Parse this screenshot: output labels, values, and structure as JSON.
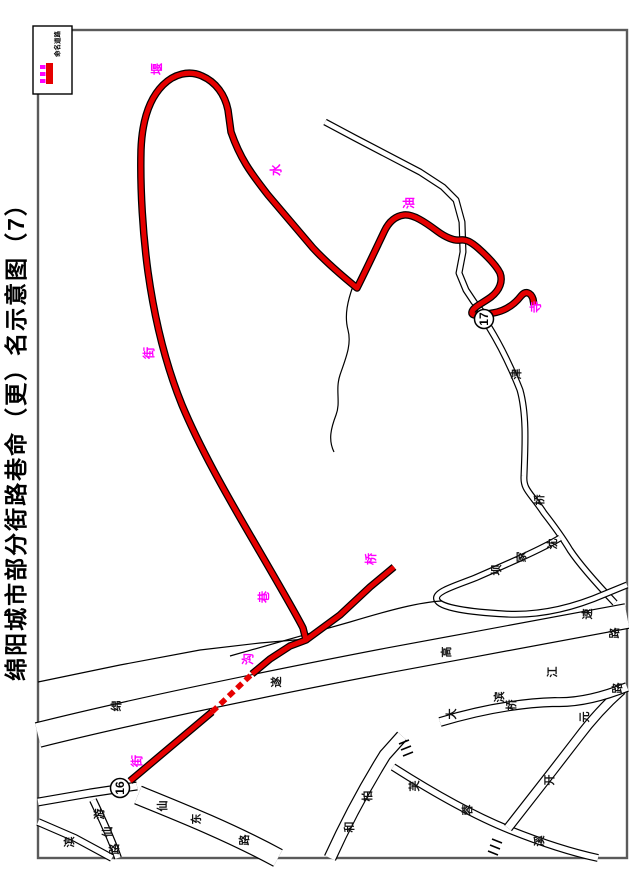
{
  "title": "绵阳城市部分街路巷命（更）名示意图（7）",
  "colors": {
    "red": "#e60000",
    "magenta": "#ff00ff",
    "ink": "#000000",
    "frame": "#5a5a5a"
  },
  "legend": {
    "label": "命名道路",
    "box": {
      "x": 33,
      "y": 26,
      "w": 39,
      "h": 68
    },
    "bar": {
      "x": 46,
      "y": 63,
      "w": 7,
      "h": 21
    },
    "ticks": [
      {
        "x": 40,
        "y": 65
      },
      {
        "x": 40,
        "y": 72
      },
      {
        "x": 40,
        "y": 79
      }
    ]
  },
  "markers": [
    {
      "label": "16",
      "x": 120,
      "y": 788
    },
    {
      "label": "17",
      "x": 484,
      "y": 319
    }
  ],
  "map": {
    "frame": {
      "x": 38,
      "y": 30,
      "w": 589,
      "h": 828
    },
    "roads": [
      {
        "d": "M38,735 C130,712 260,685 390,660 C470,645 565,628 627,616",
        "w": 26
      },
      {
        "d": "M325,122 L355,138 L420,172 L443,187 L456,200 L462,222 L463,252 L459,273 L466,290 L474,302 L482,312",
        "w": 7
      },
      {
        "d": "M489,327 C497,340 509,362 520,390 C527,415 525,448 524,476 C523,490 531,493 544,513 C551,522 561,535 570,550 C580,565 598,585 615,603",
        "w": 7
      },
      {
        "d": "M560,538 C540,550 505,565 475,578 C455,586 433,592 437,600 C440,608 470,612 505,614 C540,616 575,607 605,594 L627,585",
        "w": 7
      },
      {
        "d": "M353,286 C348,300 344,315 348,330 C352,345 345,360 340,375 C335,390 341,402 336,415 C331,428 328,440 334,452",
        "w": 0
      },
      {
        "d": "M38,682 L120,665 L200,650 L260,643 L306,639",
        "w": 0
      },
      {
        "d": "M230,656 L350,622 C390,610 420,602 442,601",
        "w": 0
      },
      {
        "d": "M38,802 L90,793 L137,786",
        "w": 9
      },
      {
        "d": "M93,800 C100,815 110,835 118,858",
        "w": 8
      },
      {
        "d": "M138,795 C180,812 230,832 278,858",
        "w": 20
      },
      {
        "d": "M38,822 L75,838 L112,858",
        "w": 8
      },
      {
        "d": "M330,858 C345,825 362,792 385,755 L402,736",
        "w": 13
      },
      {
        "d": "M393,767 C440,797 480,818 510,830 C540,842 570,852 598,858",
        "w": 8
      },
      {
        "d": "M508,828 C530,800 555,768 578,738 C590,722 605,705 622,690",
        "w": 10
      },
      {
        "d": "M440,722 C480,710 520,703 555,702 C580,703 607,695 627,687",
        "w": 10
      }
    ],
    "hatches": [
      "M399,744 L409,740 M401,750 L411,746 M403,756 L413,752",
      "M492,839 L502,843 M490,845 L500,849 M488,851 L498,855"
    ],
    "red_route": [
      {
        "d": "M130,781 L212,712",
        "dash": false
      },
      {
        "d": "M212,712 L252,674",
        "dash": true
      },
      {
        "d": "M252,674 L270,659 L290,646 L306,640 L303,628 C295,612 275,578 250,535 C225,492 200,448 182,405 C167,368 155,322 148,272 C143,235 140,190 141,150 C142,122 149,99 163,85 C174,74 189,70 202,76 C216,82 225,95 228,110 L231,132 C240,158 250,172 268,195 C285,215 296,228 313,248 C326,262 341,275 357,288 C365,272 375,251 384,232 C389,221 396,216 404,215 C413,214 425,222 437,231 C445,237 454,241 460,240 C466,239 471,242 478,248 C487,256 496,265 500,273 C503,281 500,290 491,297 C483,303 473,307 472,312 C471,317 481,315 493,313 C505,311 514,305 521,296 C526,290 531,293 533,299 L534,305",
        "dash": false
      },
      {
        "d": "M306,640 L340,615 L370,587 L394,567",
        "dash": false
      }
    ],
    "labels": [
      {
        "t": "绵",
        "x": 117,
        "y": 706,
        "c": "k"
      },
      {
        "t": "遂",
        "x": 277,
        "y": 682,
        "c": "k"
      },
      {
        "t": "高",
        "x": 447,
        "y": 652,
        "c": "k"
      },
      {
        "t": "速",
        "x": 588,
        "y": 614,
        "c": "k"
      },
      {
        "t": "路",
        "x": 615,
        "y": 633,
        "c": "k"
      },
      {
        "t": "江",
        "x": 553,
        "y": 672,
        "c": "k"
      },
      {
        "t": "滨",
        "x": 500,
        "y": 697,
        "c": "k"
      },
      {
        "t": "大",
        "x": 452,
        "y": 714,
        "c": "k"
      },
      {
        "t": "桥",
        "x": 512,
        "y": 705,
        "c": "k"
      },
      {
        "t": "沈",
        "x": 553,
        "y": 544,
        "c": "k"
      },
      {
        "t": "家",
        "x": 522,
        "y": 557,
        "c": "k"
      },
      {
        "t": "坝",
        "x": 497,
        "y": 570,
        "c": "k"
      },
      {
        "t": "津",
        "x": 517,
        "y": 374,
        "c": "k"
      },
      {
        "t": "桥",
        "x": 540,
        "y": 500,
        "c": "k"
      },
      {
        "t": "游",
        "x": 100,
        "y": 814,
        "c": "k"
      },
      {
        "t": "仙",
        "x": 108,
        "y": 832,
        "c": "k"
      },
      {
        "t": "路",
        "x": 115,
        "y": 849,
        "c": "k"
      },
      {
        "t": "仙",
        "x": 163,
        "y": 806,
        "c": "k"
      },
      {
        "t": "东",
        "x": 197,
        "y": 819,
        "c": "k"
      },
      {
        "t": "路",
        "x": 245,
        "y": 840,
        "c": "k"
      },
      {
        "t": "和",
        "x": 350,
        "y": 827,
        "c": "k"
      },
      {
        "t": "柏",
        "x": 368,
        "y": 796,
        "c": "k"
      },
      {
        "t": "芙",
        "x": 415,
        "y": 786,
        "c": "k"
      },
      {
        "t": "蓉",
        "x": 468,
        "y": 810,
        "c": "k"
      },
      {
        "t": "溪",
        "x": 540,
        "y": 841,
        "c": "k"
      },
      {
        "t": "滨",
        "x": 70,
        "y": 842,
        "c": "k"
      },
      {
        "t": "开",
        "x": 550,
        "y": 780,
        "c": "k"
      },
      {
        "t": "元",
        "x": 585,
        "y": 717,
        "c": "k"
      },
      {
        "t": "路",
        "x": 618,
        "y": 688,
        "c": "k"
      },
      {
        "t": "堰",
        "x": 157,
        "y": 69,
        "c": "m"
      },
      {
        "t": "水",
        "x": 276,
        "y": 170,
        "c": "m"
      },
      {
        "t": "油",
        "x": 409,
        "y": 203,
        "c": "m"
      },
      {
        "t": "寺",
        "x": 536,
        "y": 307,
        "c": "m"
      },
      {
        "t": "街",
        "x": 149,
        "y": 353,
        "c": "m"
      },
      {
        "t": "巷",
        "x": 264,
        "y": 597,
        "c": "m"
      },
      {
        "t": "桥",
        "x": 371,
        "y": 559,
        "c": "m"
      },
      {
        "t": "沟",
        "x": 248,
        "y": 659,
        "c": "m"
      },
      {
        "t": "街",
        "x": 137,
        "y": 761,
        "c": "m"
      }
    ]
  }
}
